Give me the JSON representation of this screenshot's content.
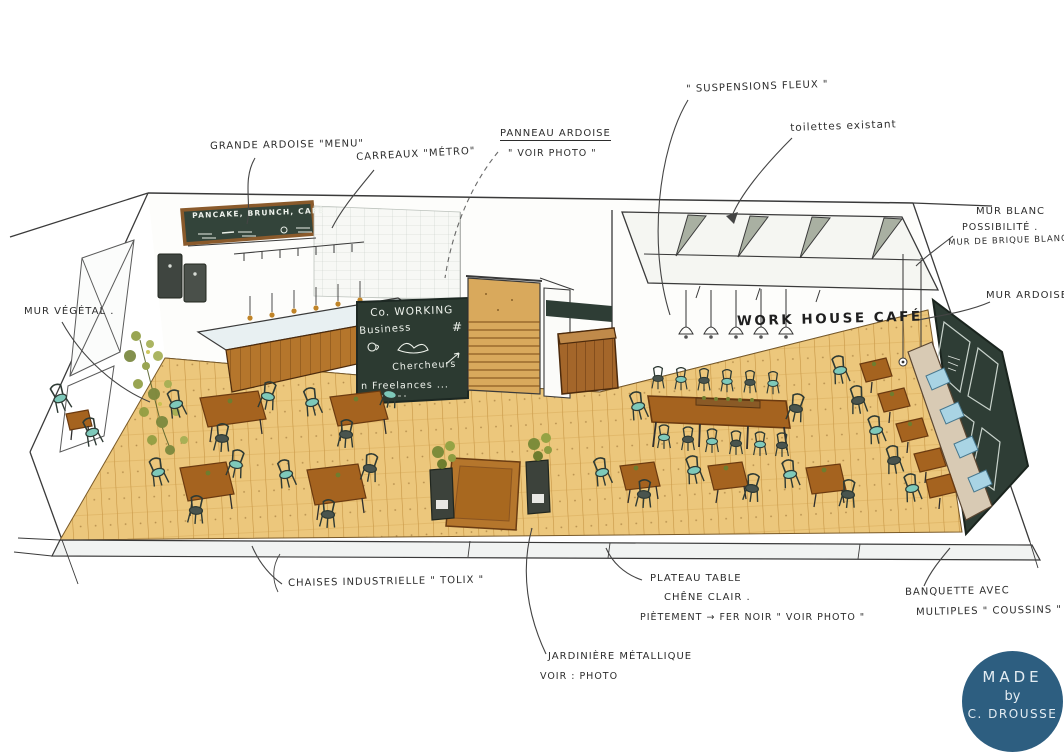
{
  "scene": {
    "subject": "Hand-drawn interior perspective sketch of the Work House Café",
    "style": "marker and watercolor sketch with handwritten French annotations"
  },
  "annotations": {
    "grande_ardoise": "GRANDE ARDOISE \"MENU\"",
    "carreaux_metro": "CARREAUX \"MÉTRO\"",
    "panneau_ardoise_1": "PANNEAU ARDOISE",
    "panneau_ardoise_2": "\" VOIR PHOTO \"",
    "suspensions": "\" SUSPENSIONS FLEUX \"",
    "toilettes": "toilettes existant",
    "mur_blanc_1": "MUR BLANC",
    "mur_blanc_2": "POSSIBILITÉ .",
    "mur_blanc_3": "MUR DE BRIQUE BLANC",
    "mur_ardoise": "MUR ARDOISE",
    "mur_vegetal": "MUR VÉGÉTAL .",
    "chaises": "CHAISES INDUSTRIELLE \" TOLIX \"",
    "plateau_1": "PLATEAU TABLE",
    "plateau_2": "CHÊNE CLAIR .",
    "plateau_3": "PIÈTEMENT → FER NOIR \" VOIR PHOTO \"",
    "banquette_1": "BANQUETTE AVEC",
    "banquette_2": "MULTIPLES \" COUSSINS \"",
    "jardiniere_1": "JARDINIÈRE MÉTALLIQUE",
    "jardiniere_2": "VOIR : PHOTO"
  },
  "drawing_text": {
    "wall_sign": "WORK HOUSE CAFÉ",
    "menu_board": "PANCAKE, BRUNCH, CAFÉ",
    "chalkboard_line1": "Co. WORKING",
    "chalkboard_line2": "Business",
    "chalkboard_hash": "#",
    "chalkboard_line3": "Chercheurs",
    "chalkboard_line4": "n Freelances ..."
  },
  "badge": {
    "line1": "MADE",
    "line2": "by",
    "line3": "C. DROUSSE",
    "color": "#2d5e80"
  },
  "colors": {
    "floor_wood": "#ecc77c",
    "table_wood": "#a5631f",
    "chair_teal": "#7ec9ba",
    "chair_dark": "#49544e",
    "chalkboard_green": "#2c3a31",
    "slate_wall": "#2e3d35",
    "cushion_blue": "#a9d4e4",
    "badge_blue": "#2d5e80",
    "ink": "#3a3a3a"
  }
}
